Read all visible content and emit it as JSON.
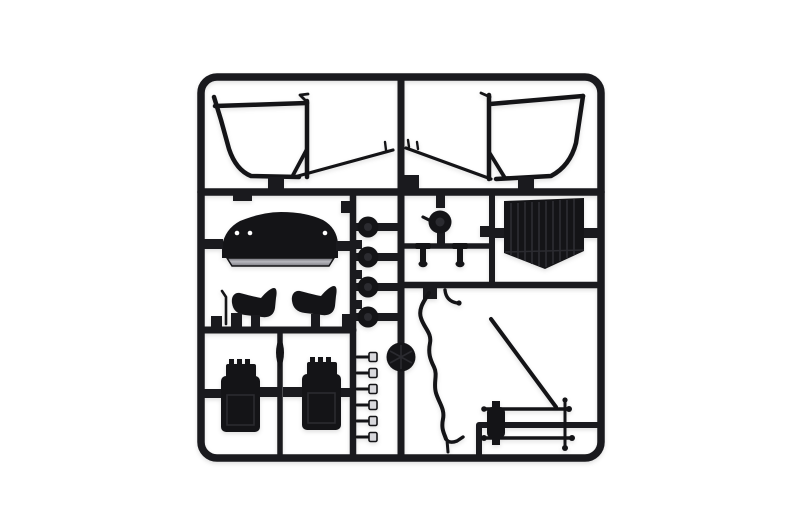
{
  "image": {
    "kind": "photograph",
    "subject": "black injection-molded model kit sprue (parts tree) on white backdrop",
    "orientation": "frame roughly centered, rounded-corner rectangular runner frame"
  },
  "colors": {
    "background": "#ffffff",
    "sprue": "#1a1a1e",
    "part-fill": "#141417",
    "rib": "#2b2b30",
    "dash-lip": "#9a9aa0",
    "highlight": "#d8d8dc"
  },
  "parts": [
    {
      "name": "windshield-frame-left",
      "desc": "trapezoid roll-over / windshield frame, top left"
    },
    {
      "name": "windshield-frame-right",
      "desc": "mirrored windshield frame, top right"
    },
    {
      "name": "thin-tube-left",
      "desc": "long thin rod angling from center runner to left frame"
    },
    {
      "name": "thin-tube-right",
      "desc": "long thin rod angling from center runner to right frame"
    },
    {
      "name": "dashboard-cowl",
      "desc": "domed dashboard / cowl panel with three holes"
    },
    {
      "name": "seat-left",
      "desc": "bucket seat shell, side profile"
    },
    {
      "name": "seat-right",
      "desc": "bucket seat shell, side profile"
    },
    {
      "name": "shift-lever",
      "desc": "thin gear lever next to left seat"
    },
    {
      "name": "wheel-hub-column",
      "desc": "four round hub/drum discs between two vertical runners"
    },
    {
      "name": "steering-disc",
      "desc": "large round disc molded on center runner"
    },
    {
      "name": "pin-column",
      "desc": "six small bright-headed pins on vertical runner"
    },
    {
      "name": "pulley",
      "desc": "small pulley with lever arm"
    },
    {
      "name": "tie-rod-pins",
      "desc": "two T-shaped linkage pins"
    },
    {
      "name": "radiator",
      "desc": "ribbed radiator panel with pointed bottom"
    },
    {
      "name": "flexible-tube",
      "desc": "long wavy tube hanging from mid runner"
    },
    {
      "name": "diagonal-rod",
      "desc": "straight diagonal rod, lower right"
    },
    {
      "name": "axle-assembly",
      "desc": "two horizontal axle rods, gearbox block and cross pin"
    },
    {
      "name": "drive-spindle",
      "desc": "lens-shaped spindle swelling on runner between tanks"
    },
    {
      "name": "fuel-tank-left",
      "desc": "ribbed-top tank block, bottom left"
    },
    {
      "name": "fuel-tank-right",
      "desc": "ribbed-top tank block, bottom left"
    }
  ]
}
